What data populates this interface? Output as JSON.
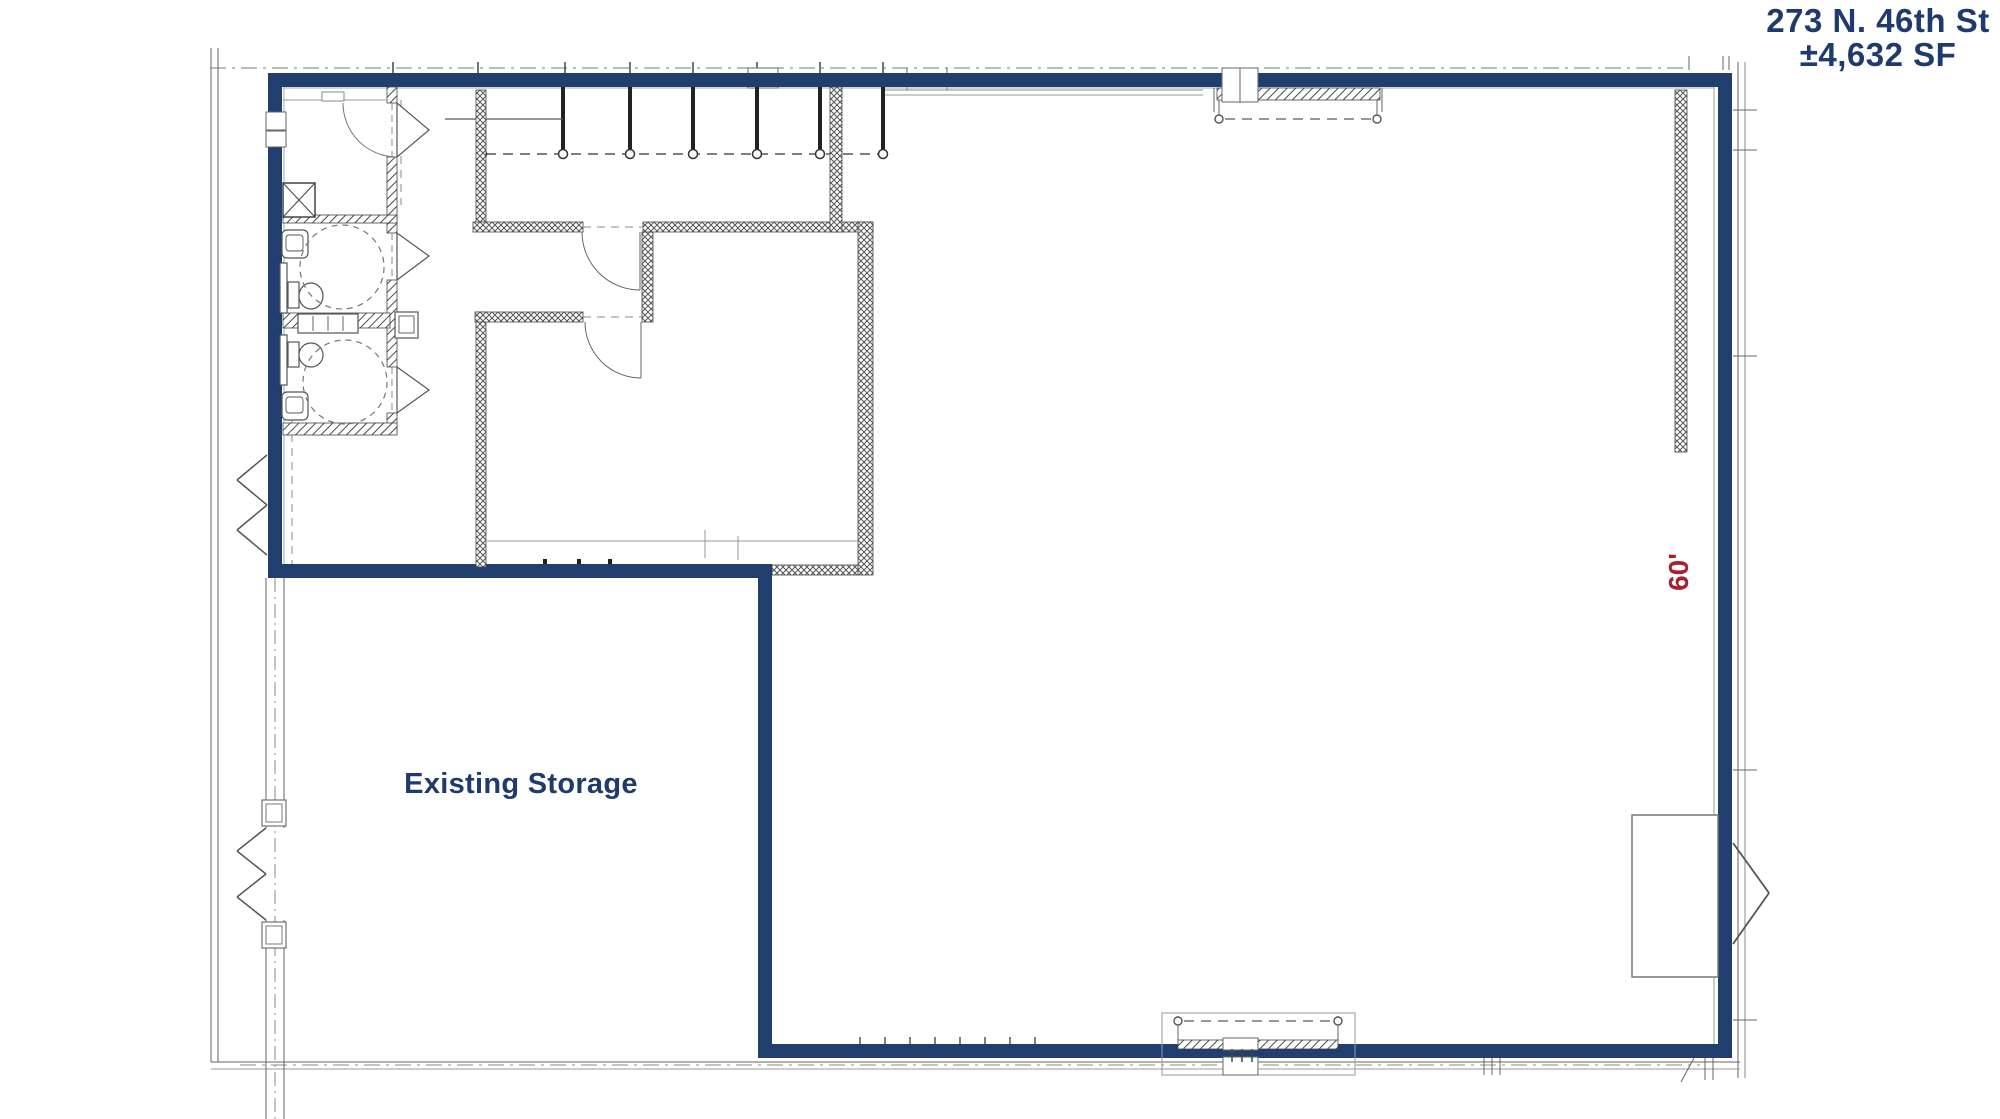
{
  "header": {
    "address_line1": "273 N. 46th St",
    "address_line2": "±4,632 SF"
  },
  "floor_plan": {
    "storage_room_label": "Existing Storage",
    "right_wall_dimension": "60'",
    "colors": {
      "lease_boundary_blue": "#203e6e",
      "label_text_blue": "#1e3a6e",
      "dimension_red": "#a8202f",
      "drawing_line_gray": "#555555"
    }
  }
}
